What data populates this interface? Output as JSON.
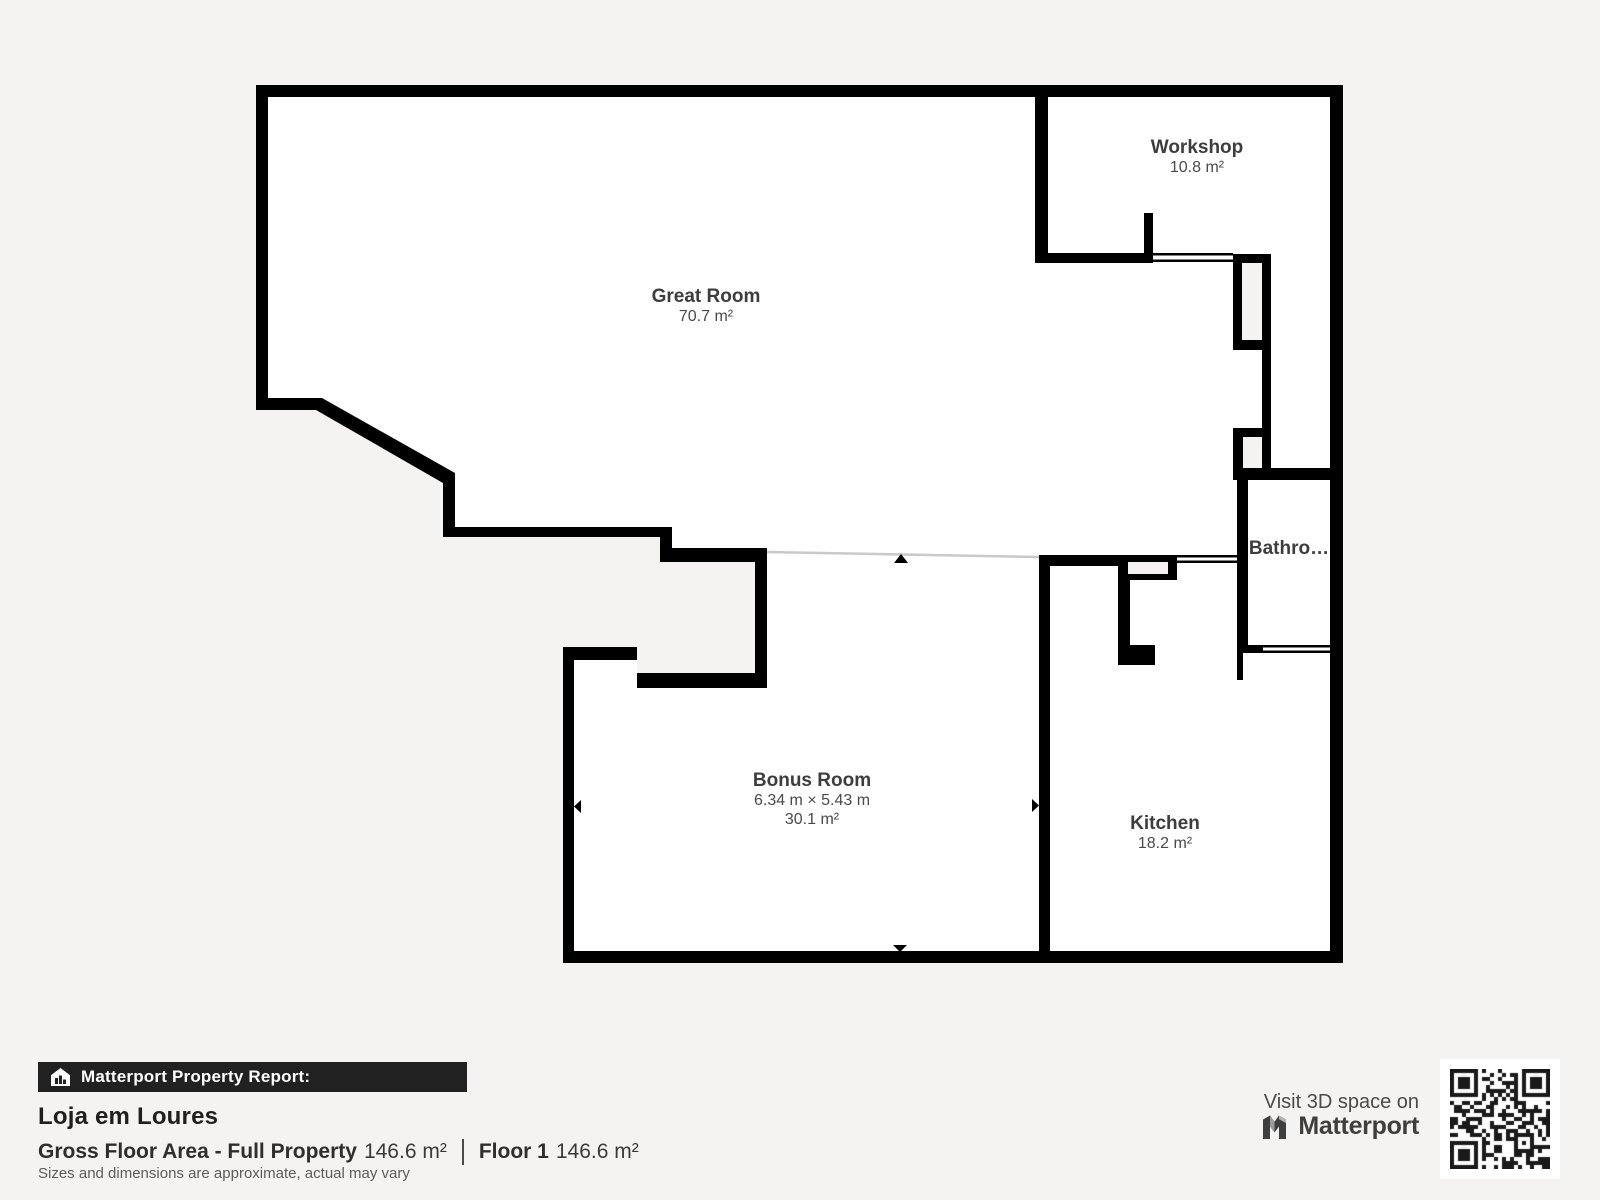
{
  "floor_plan": {
    "rooms": {
      "great_room": {
        "name": "Great Room",
        "area": "70.7 m²"
      },
      "workshop": {
        "name": "Workshop",
        "area": "10.8 m²"
      },
      "bathroom": {
        "name": "Bathro…"
      },
      "bonus_room": {
        "name": "Bonus Room",
        "dimensions": "6.34 m × 5.43 m",
        "area": "30.1 m²"
      },
      "kitchen": {
        "name": "Kitchen",
        "area": "18.2 m²"
      }
    },
    "colors": {
      "background": "#f4f3f1",
      "interior": "#ffffff",
      "walls": "#000000",
      "open_boundary_line": "#c9c9c9",
      "label_title": "#3d3d3d",
      "label_detail": "#4a4a4a"
    }
  },
  "report": {
    "bar_label": "Matterport Property Report:",
    "property_name": "Loja em Loures",
    "gfa_label": "Gross Floor Area - Full Property",
    "gfa_value": "146.6 m²",
    "floor_label": "Floor 1",
    "floor_value": "146.6 m²",
    "disclaimer": "Sizes and dimensions are approximate, actual may vary"
  },
  "promo": {
    "visit_label": "Visit 3D space on",
    "brand": "Matterport"
  }
}
